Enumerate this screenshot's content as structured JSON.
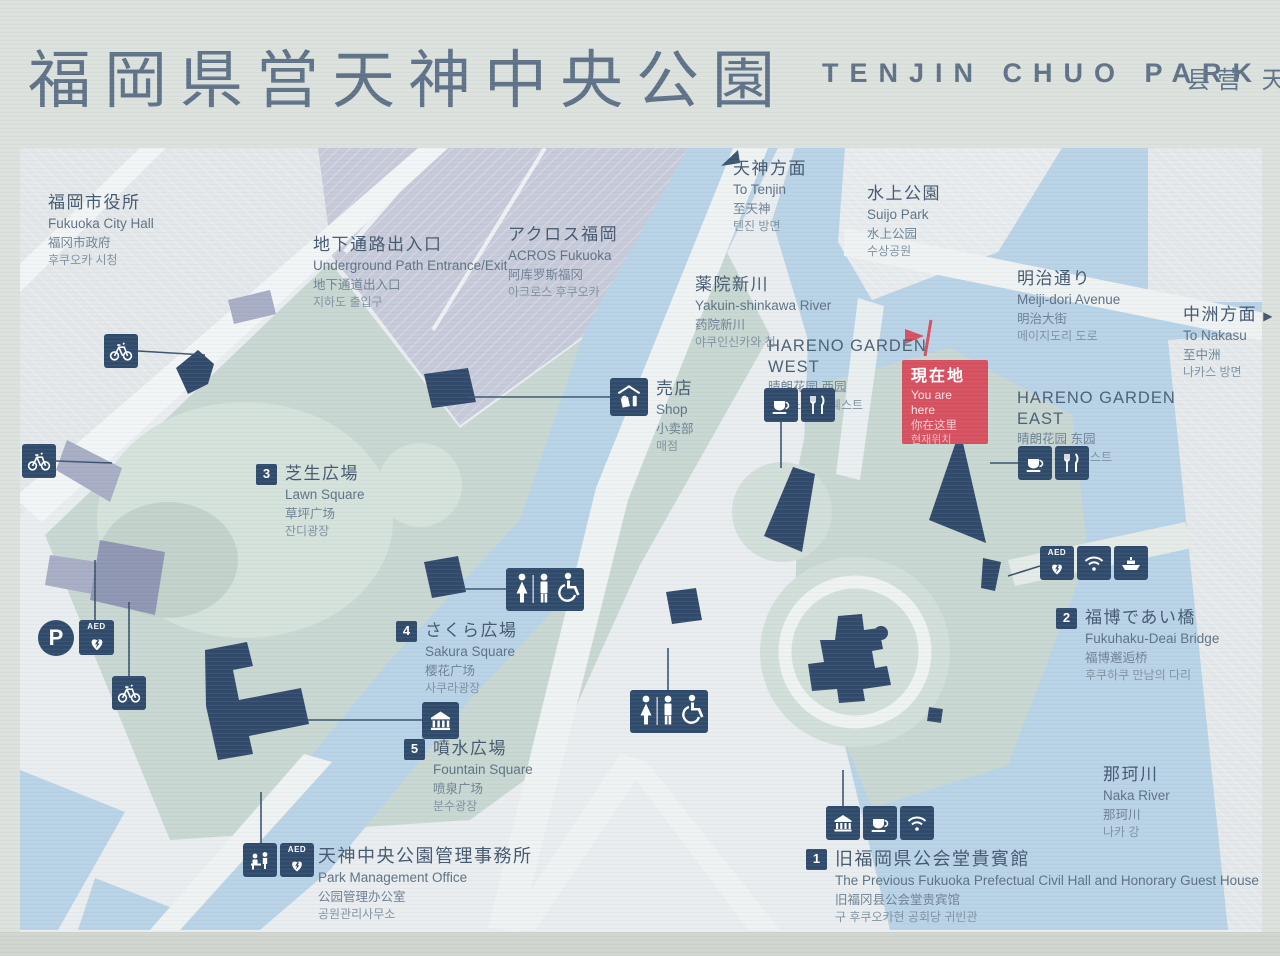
{
  "title": {
    "ja": "福岡県営天神中央公園",
    "en": "TENJIN CHUO PARK",
    "zh": "县营 天"
  },
  "you_are_here": {
    "ja": "現在地",
    "en": "You are here",
    "zh": "你在这里",
    "ko": "현재위치"
  },
  "labels": {
    "city_hall": {
      "ja": "福岡市役所",
      "en": "Fukuoka City Hall",
      "zh": "福冈市政府",
      "ko": "후쿠오카 시청"
    },
    "underground": {
      "ja": "地下通路出入口",
      "en": "Underground Path Entrance/Exit",
      "zh": "地下通道出入口",
      "ko": "지하도 출입구"
    },
    "acros": {
      "ja": "アクロス福岡",
      "en": "ACROS Fukuoka",
      "zh": "阿库罗斯福冈",
      "ko": "아크로스 후쿠오카"
    },
    "to_tenjin": {
      "ja": "天神方面",
      "en": "To Tenjin",
      "zh": "至天神",
      "ko": "텐진 방면"
    },
    "suijo_park": {
      "ja": "水上公園",
      "en": "Suijo Park",
      "zh": "水上公园",
      "ko": "수상공원"
    },
    "yakuin_river": {
      "ja": "薬院新川",
      "en": "Yakuin-shinkawa River",
      "zh": "药院新川",
      "ko": "야쿠인신카와 천"
    },
    "meiji_dori": {
      "ja": "明治通り",
      "en": "Meiji-dori Avenue",
      "zh": "明治大街",
      "ko": "메이지도리 도로"
    },
    "to_nakasu": {
      "ja": "中洲方面",
      "arrow": "▶",
      "en": "To Nakasu",
      "zh": "至中洲",
      "ko": "나카스 방면"
    },
    "hareno_west": {
      "en1": "HARENO GARDEN",
      "en2": "WEST",
      "zh": "晴朗花园 西园",
      "ko": "하레노 가든 웨스트"
    },
    "hareno_east": {
      "en1": "HARENO GARDEN",
      "en2": "EAST",
      "zh": "晴朗花园 东园",
      "ko": "하레노 가든 이스트"
    },
    "shop": {
      "ja": "売店",
      "en": "Shop",
      "zh": "小卖部",
      "ko": "매점"
    },
    "lawn_square": {
      "num": "3",
      "ja": "芝生広場",
      "en": "Lawn Square",
      "zh": "草坪广场",
      "ko": "잔디광장"
    },
    "sakura_square": {
      "num": "4",
      "ja": "さくら広場",
      "en": "Sakura Square",
      "zh": "樱花广场",
      "ko": "사쿠라광장"
    },
    "fountain_square": {
      "num": "5",
      "ja": "噴水広場",
      "en": "Fountain Square",
      "zh": "喷泉广场",
      "ko": "분수광장"
    },
    "deai_bridge": {
      "num": "2",
      "ja": "福博であい橋",
      "en": "Fukuhaku-Deai Bridge",
      "zh": "福博邂逅桥",
      "ko": "후쿠하쿠 만남의 다리"
    },
    "naka_river": {
      "ja": "那珂川",
      "en": "Naka River",
      "zh": "那珂川",
      "ko": "나카 강"
    },
    "office": {
      "ja": "天神中央公園管理事務所",
      "en": "Park Management Office",
      "zh": "公园管理办公室",
      "ko": "공원관리사무소"
    },
    "civil_hall": {
      "num": "1",
      "ja": "旧福岡県公会堂貴賓館",
      "en": "The Previous Fukuoka Prefectual Civil Hall and Honorary Guest House",
      "zh": "旧福冈县公会堂贵宾馆",
      "ko": "구 후쿠오카현 공회당 귀빈관"
    }
  },
  "icons": {
    "parking_label": "P",
    "aed_label": "AED",
    "names": [
      "bicycle-icon",
      "parking-icon",
      "aed-icon",
      "toilet-icon",
      "wheelchair-icon",
      "shop-icon",
      "cafe-icon",
      "restaurant-icon",
      "wifi-icon",
      "ship-icon",
      "guesthouse-icon",
      "info-desk-icon",
      "monument-icon",
      "you-are-here-flag-icon",
      "to-tenjin-arrow-icon",
      "to-nakasu-arrow-icon"
    ]
  },
  "colors": {
    "navy": "#2F4A6A",
    "red": "#D6505F",
    "water": "#B9D3E6",
    "park_green": "#C8D7D1",
    "title": "#5F7287"
  }
}
